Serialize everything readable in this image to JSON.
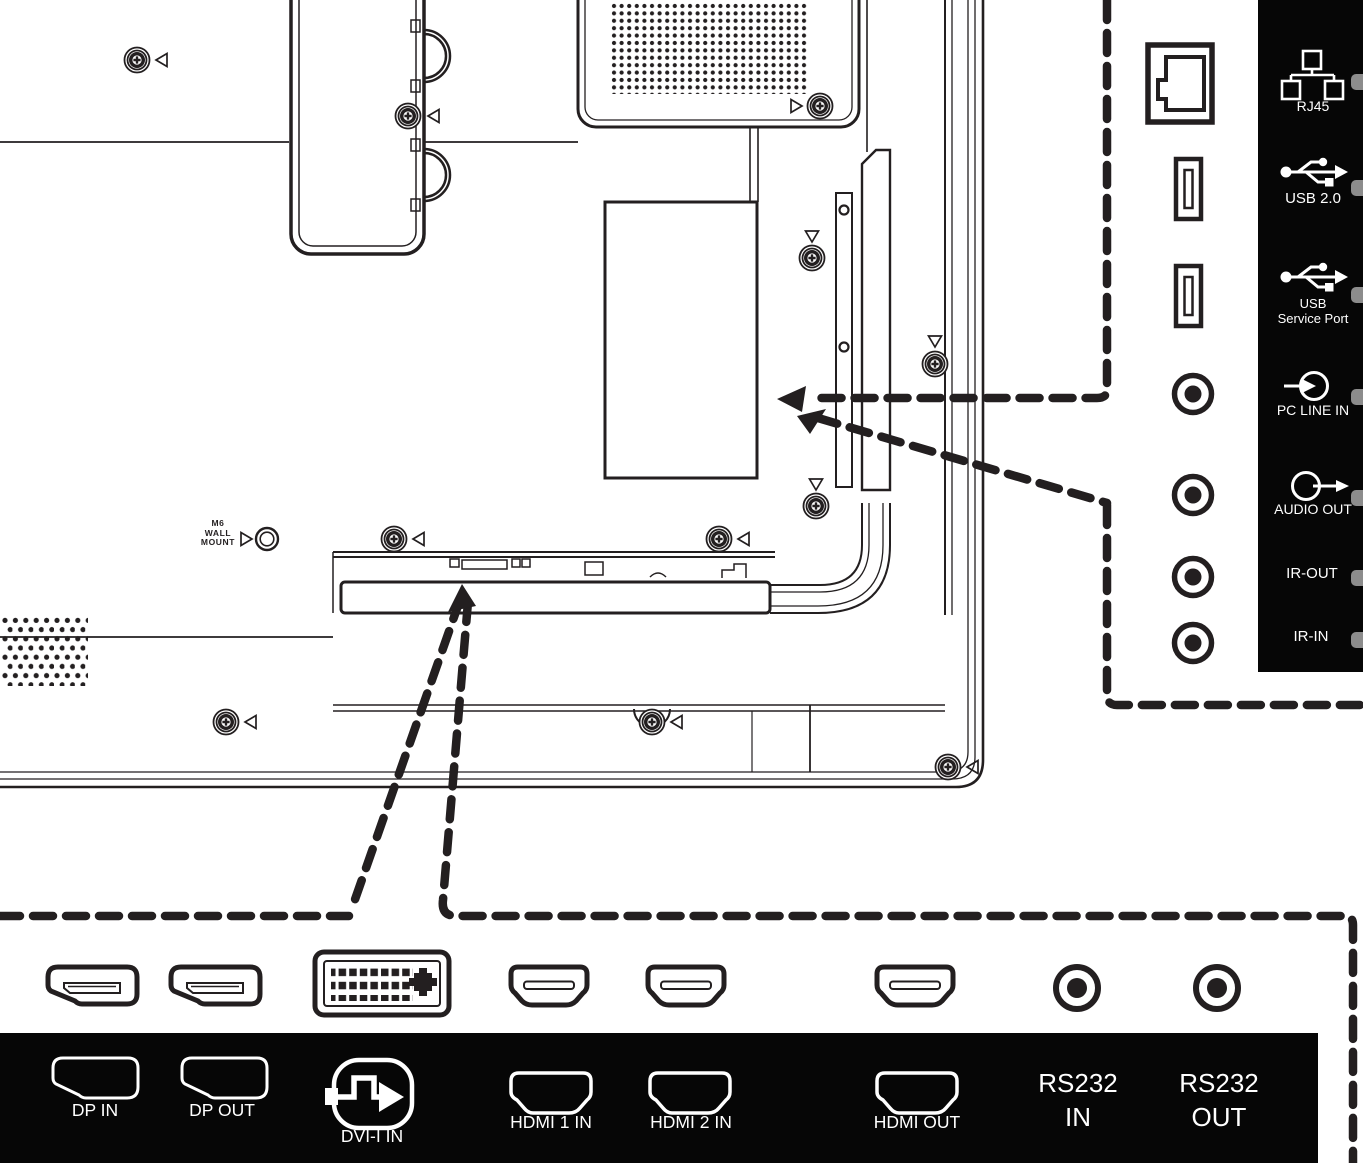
{
  "title": "display-rear-panel-connector-diagram",
  "colors": {
    "line": "#231f20",
    "panel_background": "#060606",
    "label_text": "#ffffff",
    "stub_gray": "#8c8c8c",
    "page_background": "#ffffff"
  },
  "rear_view": {
    "wall_mount": {
      "line1": "M6",
      "line2": "WALL",
      "line3": "MOUNT"
    }
  },
  "side_panel": {
    "ports": [
      {
        "label": "RJ45",
        "icon": "network-tree-icon"
      },
      {
        "label": "USB 2.0",
        "icon": "usb-trident-icon"
      },
      {
        "label_line1": "USB",
        "label_line2": "Service Port",
        "icon": "usb-trident-icon"
      },
      {
        "label": "PC LINE IN",
        "icon": "line-in-arrow-icon"
      },
      {
        "label": "AUDIO OUT",
        "icon": "audio-out-arrow-icon"
      },
      {
        "label": "IR-OUT"
      },
      {
        "label": "IR-IN"
      }
    ]
  },
  "bottom_panel": {
    "ports": [
      {
        "label": "DP IN",
        "icon": "displayport-icon"
      },
      {
        "label": "DP OUT",
        "icon": "displayport-icon"
      },
      {
        "label": "DVI-I IN",
        "icon": "dvi-signal-icon"
      },
      {
        "label": "HDMI 1 IN",
        "icon": "hdmi-icon"
      },
      {
        "label": "HDMI 2 IN",
        "icon": "hdmi-icon"
      },
      {
        "label": "HDMI OUT",
        "icon": "hdmi-icon"
      },
      {
        "label_line1": "RS232",
        "label_line2": "IN"
      },
      {
        "label_line1": "RS232",
        "label_line2": "OUT"
      }
    ]
  }
}
